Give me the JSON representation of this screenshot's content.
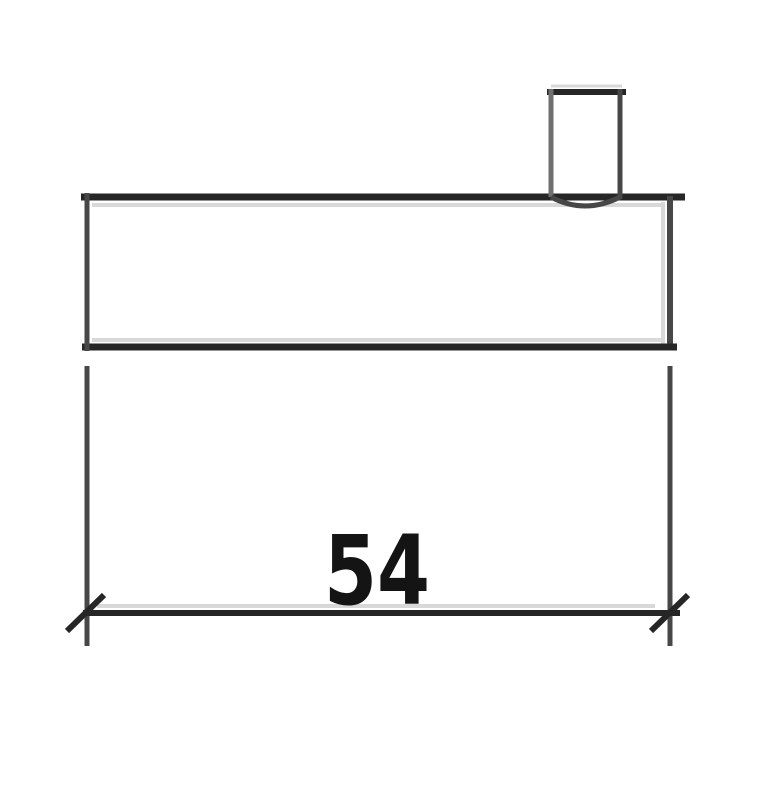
{
  "diagram": {
    "dimension_label": "54",
    "colors": {
      "background": "#ffffff",
      "stroke_dark": "#262626",
      "stroke_mid": "#474747",
      "stroke_gray": "#6f6f6f",
      "stroke_light": "#d8d8d8",
      "label": "#141414"
    }
  }
}
